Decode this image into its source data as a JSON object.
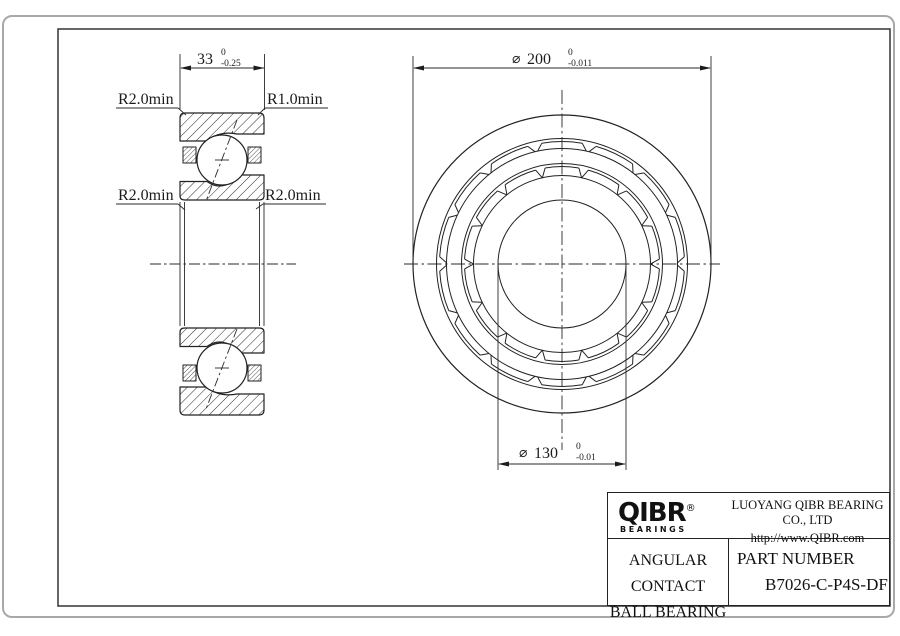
{
  "section_view": {
    "dim_width": {
      "value": "33",
      "tol_upper": "0",
      "tol_lower": "-0.25"
    },
    "labels": {
      "top_left": "R2.0min",
      "top_right": "R1.0min",
      "mid_left": "R2.0min",
      "mid_right": "R2.0min"
    }
  },
  "front_view": {
    "dim_od": {
      "symbol": "⌀",
      "value": "200",
      "tol_upper": "0",
      "tol_lower": "-0.011"
    },
    "dim_bore": {
      "symbol": "⌀",
      "value": "130",
      "tol_upper": "0",
      "tol_lower": "-0.01"
    }
  },
  "title_block": {
    "logo_name": "QIBR",
    "logo_registered": "®",
    "logo_sub": "BEARINGS",
    "company": "LUOYANG QIBR BEARING CO., LTD",
    "website": "http://www.QIBR.com",
    "product_line1": "ANGULAR CONTACT",
    "product_line2": "BALL BEARING",
    "part_number_label": "PART NUMBER",
    "part_number": "B7026-C-P4S-DF"
  },
  "colors": {
    "line": "#222222",
    "card_border": "#a8a8a8",
    "background": "#ffffff"
  }
}
